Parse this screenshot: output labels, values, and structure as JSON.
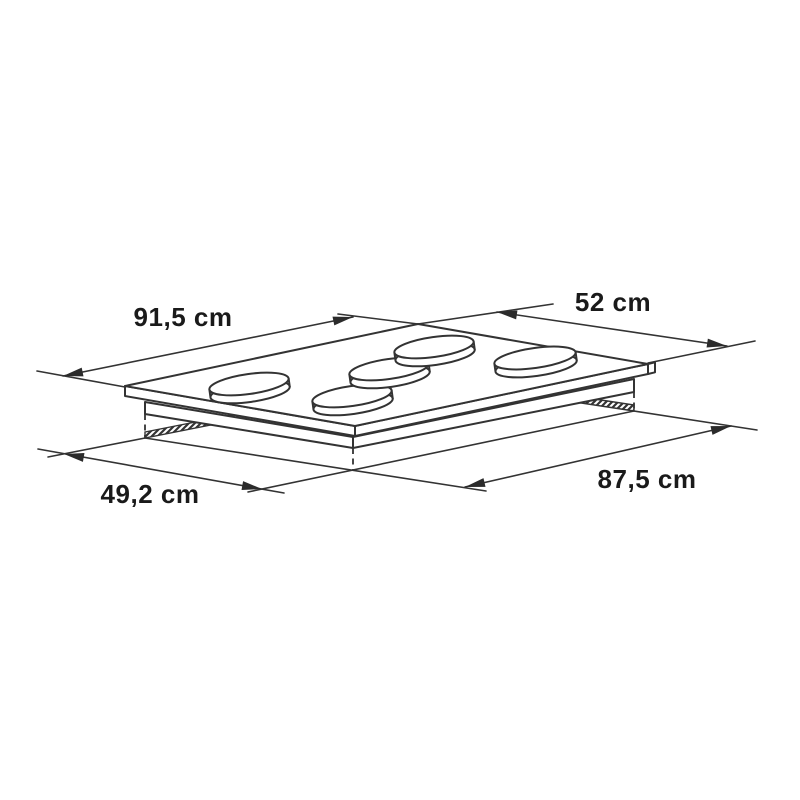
{
  "dimensions": {
    "top_length": {
      "label": "91,5 cm"
    },
    "top_depth": {
      "label": "52 cm"
    },
    "cutout_depth": {
      "label": "49,2 cm"
    },
    "cutout_length": {
      "label": "87,5 cm"
    }
  },
  "product": {
    "burner_count": 5
  },
  "colors": {
    "background": "#ffffff",
    "line": "#333333",
    "label_text": "#1a1a1a"
  }
}
